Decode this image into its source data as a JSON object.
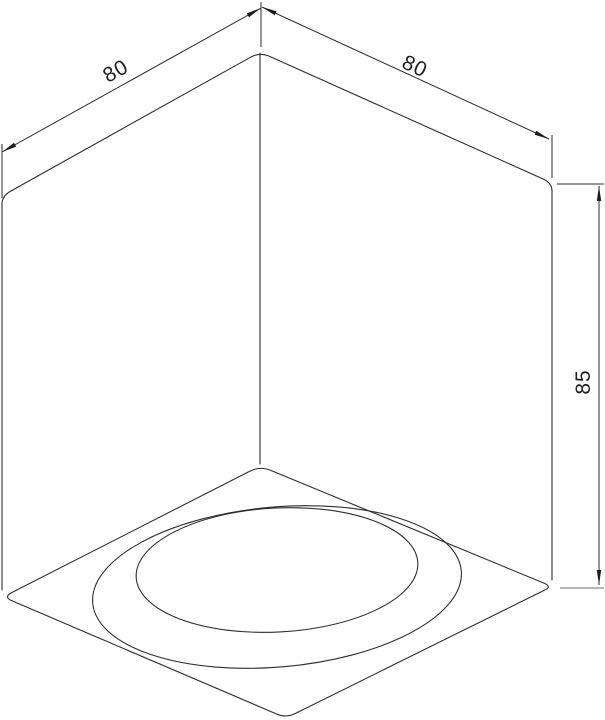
{
  "page": {
    "background_color": "#ffffff"
  },
  "drawing": {
    "kind": "isometric-dimension-drawing",
    "line_color": "#2d2d2d",
    "extension_line_gray": "#9d9d9d",
    "dimensions": {
      "width_left": "80",
      "width_right": "80",
      "height": "85"
    }
  }
}
